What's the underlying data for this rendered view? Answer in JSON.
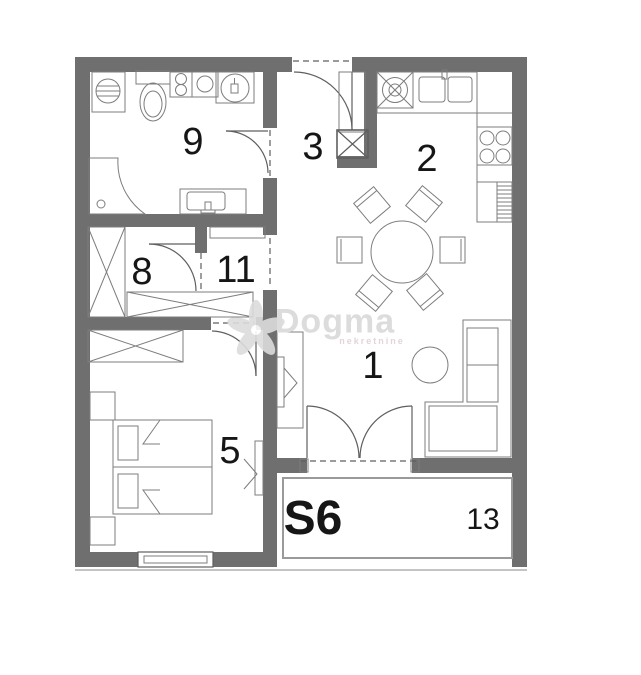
{
  "plan": {
    "unit_label": "S6",
    "watermark": {
      "brand": "Dogma",
      "tagline": "nekretnine"
    },
    "rooms": [
      {
        "name": "living-room",
        "label": "1"
      },
      {
        "name": "kitchen",
        "label": "2"
      },
      {
        "name": "entry",
        "label": "3"
      },
      {
        "name": "bedroom",
        "label": "5"
      },
      {
        "name": "closet",
        "label": "8"
      },
      {
        "name": "bathroom",
        "label": "9"
      },
      {
        "name": "hallway",
        "label": "11"
      },
      {
        "name": "balcony",
        "label": "13"
      }
    ],
    "colors": {
      "wall": "#6f6f6f",
      "line": "#5f5f5f",
      "furniture": "#7d7d7d",
      "label": "#161616",
      "watermark": "#dcdcdc",
      "background": "#ffffff"
    }
  }
}
